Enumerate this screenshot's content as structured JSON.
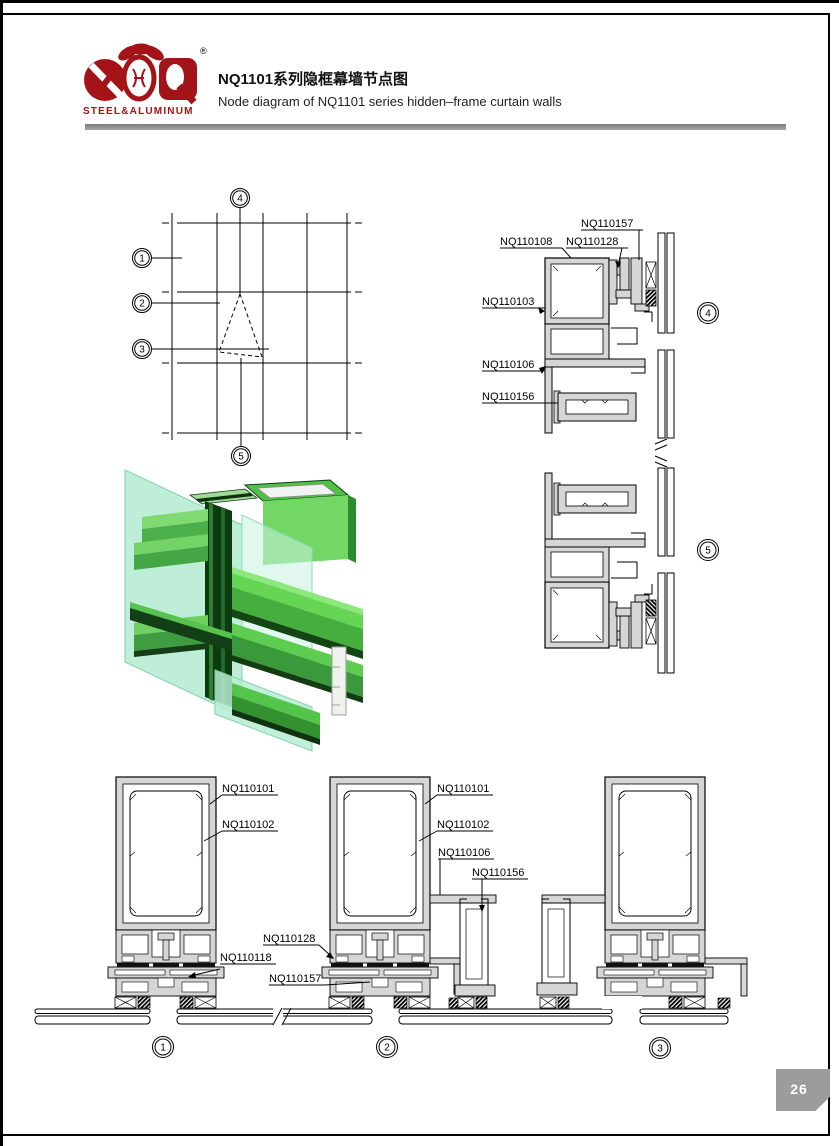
{
  "page": {
    "number": "26"
  },
  "header": {
    "brand": "STEEL&ALUMINUM",
    "reg_mark": "®",
    "title_zh": "NQ1101系列隐框幕墙节点图",
    "title_en": "Node diagram of NQ1101 series hidden–frame curtain walls",
    "accent_red": "#a31318",
    "rule_gray": "#8f8f8f"
  },
  "key_plan": {
    "c1": "1",
    "c2": "2",
    "c3": "3",
    "c4": "4",
    "c5": "5"
  },
  "right_section": {
    "c4": "4",
    "c5": "5",
    "nq110157": "NQ110157",
    "nq110108": "NQ110108",
    "nq110128": "NQ110128",
    "nq110103": "NQ110103",
    "nq110106": "NQ110106",
    "nq110156": "NQ110156"
  },
  "bottom_sections": {
    "c1": "1",
    "c2": "2",
    "c3": "3",
    "d1": {
      "nq110101": "NQ110101",
      "nq110102": "NQ110102",
      "nq110118": "NQ110118"
    },
    "mid": {
      "nq110128": "NQ110128",
      "nq110157": "NQ110157"
    },
    "d2": {
      "nq110101": "NQ110101",
      "nq110102": "NQ110102",
      "nq110106": "NQ110106",
      "nq110156": "NQ110156"
    }
  },
  "colors": {
    "profile_fill": "#d6d6d6",
    "iso_glass": "#b7ecd3",
    "iso_green_light": "#7dd96f",
    "iso_green_mid": "#46ae3f",
    "iso_green_dark": "#0e3a12",
    "tab_gray": "#9c9c9c"
  }
}
